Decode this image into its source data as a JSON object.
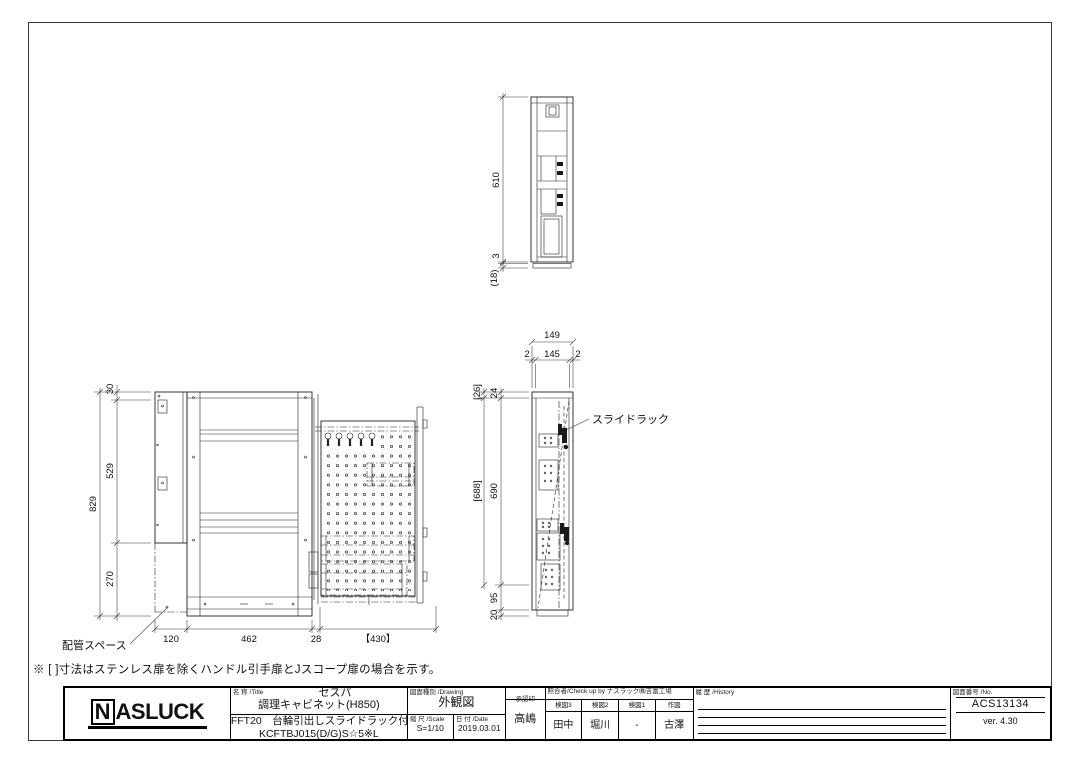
{
  "sheet": {
    "note": "※ [ ]寸法はステンレス扉を除くハンドル引手扉とJスコープ扉の場合を示す。"
  },
  "views": {
    "front": {
      "dim_total_height": "829",
      "dim_seg_top": "30",
      "dim_seg_mid": "529",
      "dim_seg_bottom": "270",
      "dim_w1": "120",
      "dim_w2": "462",
      "dim_w3": "28",
      "dim_w4": "【430】",
      "annotation_piping": "配管スペース"
    },
    "side": {
      "dim_total_width": "149",
      "dim_w_left": "2",
      "dim_w_mid": "145",
      "dim_w_right": "2",
      "dim_alt_top": "[26]",
      "dim_top": "24",
      "dim_alt_body": "[688]",
      "dim_body": "690",
      "dim_base_upper": "95",
      "dim_base_lower": "20",
      "annotation_slide_rack": "スライドラック"
    },
    "top": {
      "dim_depth": "610",
      "dim_gap": "3",
      "dim_base": "(18)"
    }
  },
  "title_block": {
    "logo_n": "N",
    "logo_rest": "ASLUCK",
    "title_label": "名 称 /Title",
    "series": "セスパ",
    "product": "調理キャビネット(H850)",
    "model_desc": "FFT20　台輪引出しスライドラック付",
    "model_code": "KCFTBJ015(D/G)S☆5※L",
    "drawing_label": "図面種別 /Drawing",
    "drawing_type": "外観図",
    "scale_label": "縮 尺 /Scale",
    "scale_value": "S=1/10",
    "date_label": "日 付 /Date",
    "date_value": "2019.03.01",
    "approval_label": "承認印",
    "approval_value": "高嶋",
    "check_label": "照合者/Check up by ナスラック㈱吉富工場",
    "check_cols": [
      {
        "label": "検図3",
        "value": "田中"
      },
      {
        "label": "検図2",
        "value": "堀川"
      },
      {
        "label": "検図1",
        "value": "-"
      },
      {
        "label": "作図",
        "value": "古澤"
      }
    ],
    "history_label": "履 歴 /History",
    "number_label": "図面番号 /No.",
    "number_value": "ACS13134",
    "version": "ver. 4.30"
  }
}
